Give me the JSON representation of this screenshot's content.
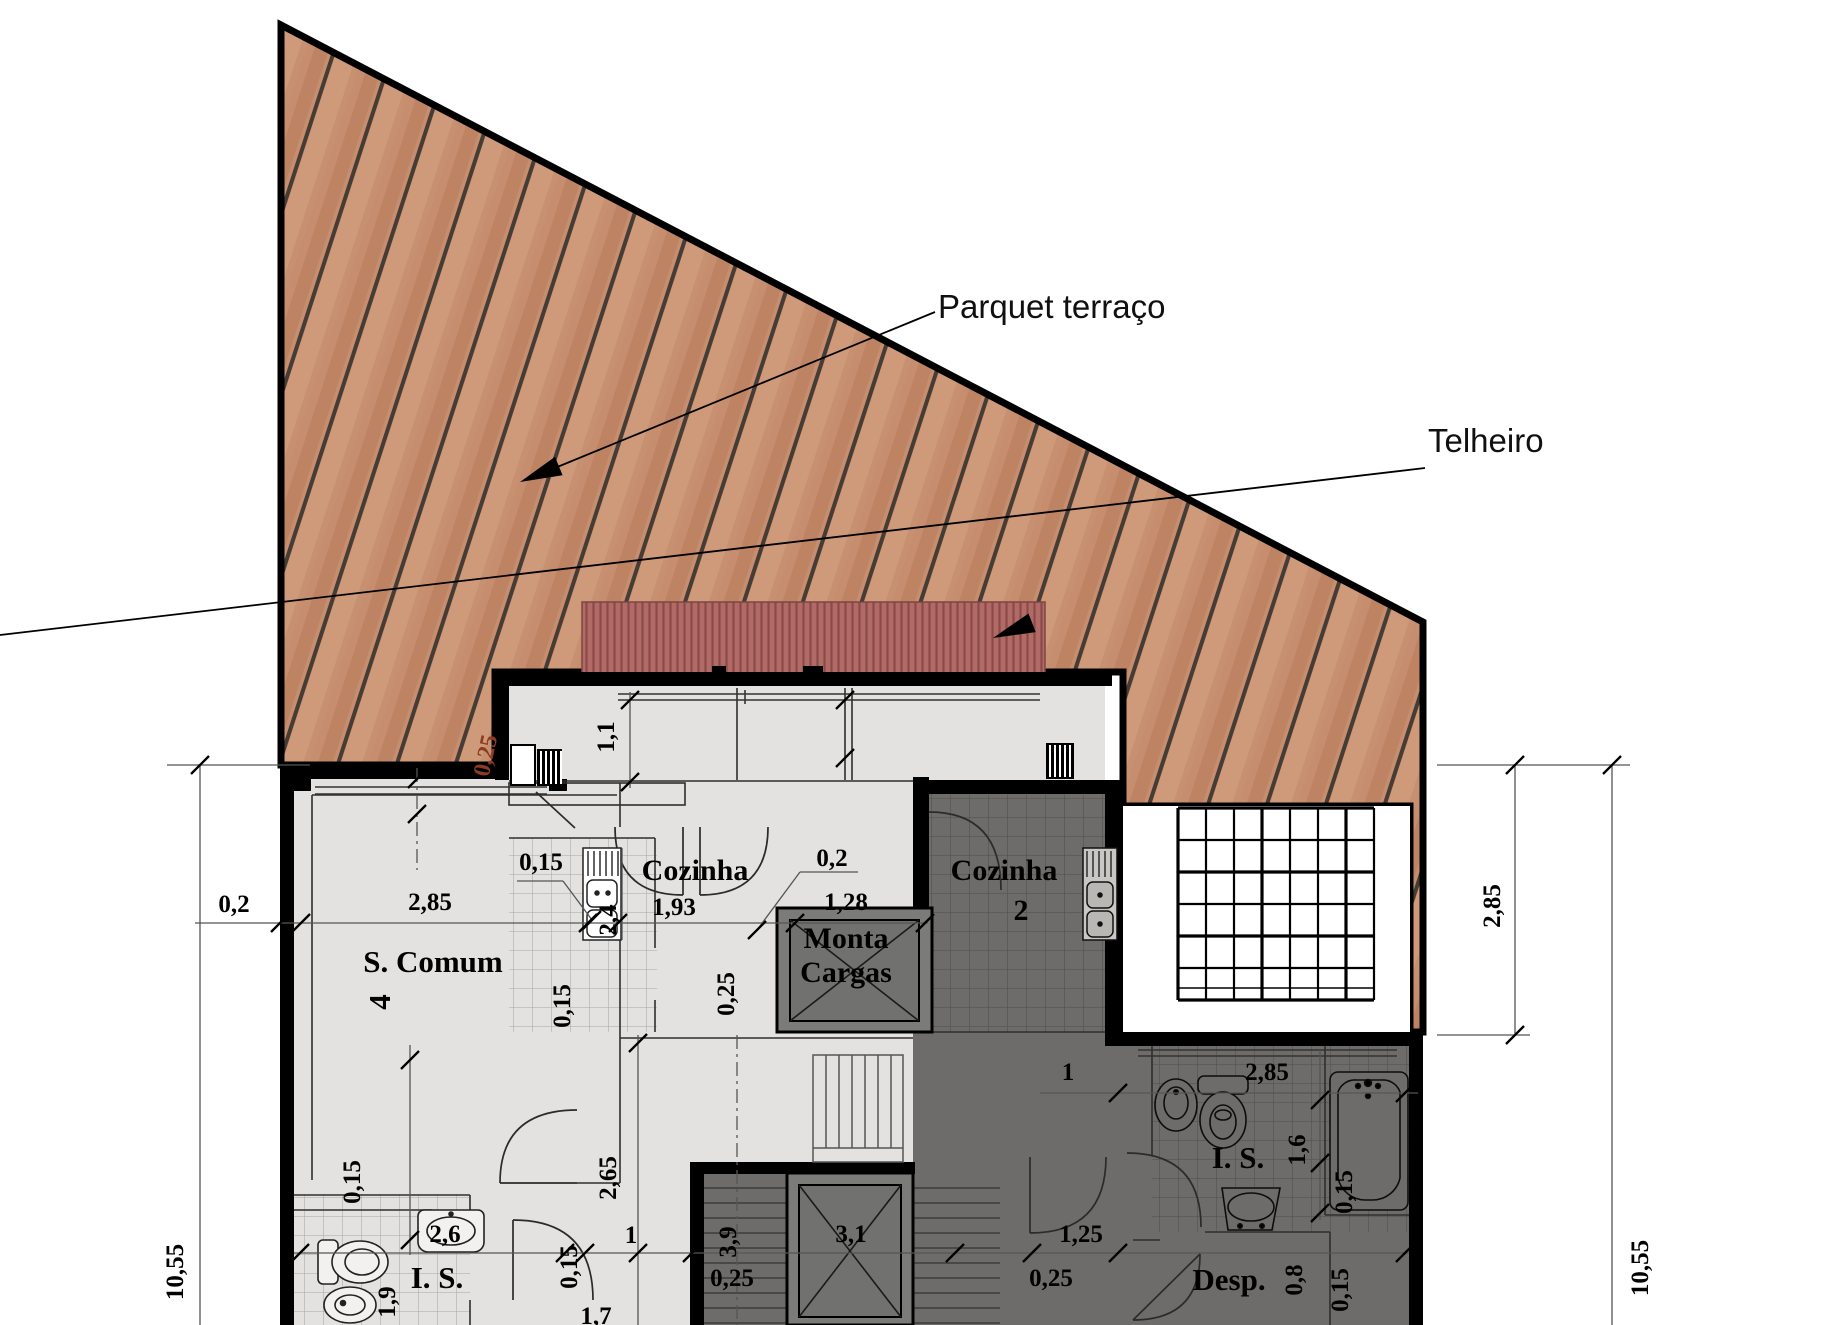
{
  "annotations": {
    "parquet": "Parquet terraço",
    "telheiro": "Telheiro"
  },
  "rooms": {
    "s_comum": "S. Comum",
    "s_comum_n": "4",
    "cozinha_1": "Cozinha",
    "cozinha_2": "Cozinha",
    "cozinha_2_n": "2",
    "monta_1": "Monta",
    "monta_2": "Cargas",
    "is_dark": "I. S.",
    "is_light": "I. S.",
    "desp": "Desp."
  },
  "dims": {
    "d_02a": "0,2",
    "d_285a": "2,85",
    "d_015a": "0,15",
    "d_025red": "0,25",
    "d_11": "1,1",
    "d_193": "1,93",
    "d_24": "2,4",
    "d_02b": "0,2",
    "d_128": "1,28",
    "d_025a": "0,25",
    "d_015b": "0,15",
    "d_1a": "1",
    "d_285b": "2,85",
    "d_16": "1,6",
    "d_015c": "0,15",
    "d_125": "1,25",
    "d_025b": "0,25",
    "d_08": "0,8",
    "d_015d": "0,15",
    "d_39": "3,9",
    "d_31": "3,1",
    "d_025c": "0,25",
    "d_265": "2,65",
    "d_1b": "1",
    "d_015e": "0,15",
    "d_26": "2,6",
    "d_19": "1,9",
    "d_015f": "0,15",
    "d_17": "1,7",
    "d_1055L": "10,55",
    "d_1055R": "10,55",
    "d_285R": "2,85"
  },
  "colors": {
    "deck_base": "#c68e6e",
    "deck_plank_line": "#453c35",
    "roof": "#b26a66",
    "roof_stripe": "#8a4b48",
    "floor_light": "#e4e2e0",
    "floor_dark": "#6e6c6a",
    "wall": "#000000",
    "red_dim_text": "#8c3c22"
  }
}
